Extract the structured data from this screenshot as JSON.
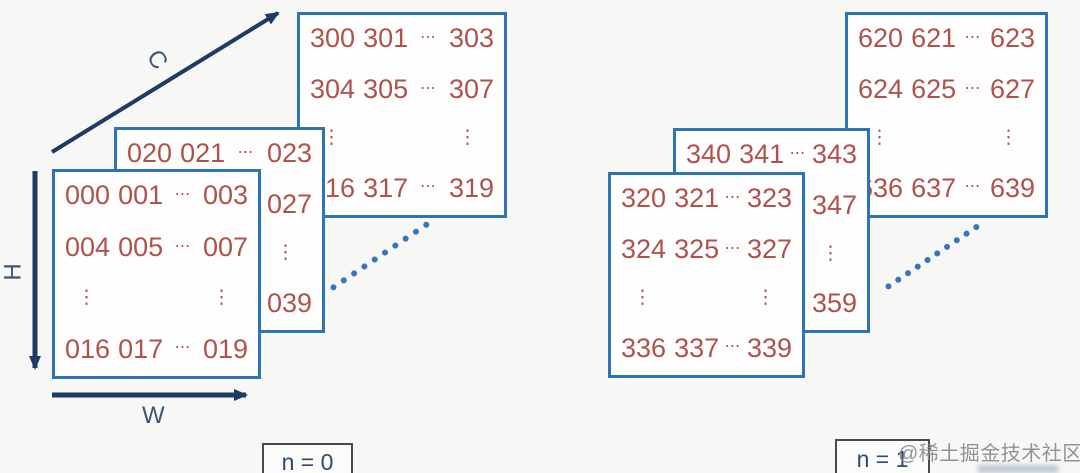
{
  "diagram": {
    "description": "NCHW tensor memory layout",
    "watermark": "@稀土掘金技术社区"
  },
  "colors": {
    "background": "#f7f7f5",
    "matrix_border": "#2e74b5",
    "matrix_fill": "#fefefe",
    "number_text": "#b0524c",
    "axis_arrow": "#1f3a64",
    "axis_label_text": "#3d5677",
    "dotted_line": "#3b74b8",
    "n_box_border": "#4a4a4a",
    "n_label_text": "#2e4b6f",
    "watermark_text": "#8a8a8a"
  },
  "axis_labels": {
    "c": "C",
    "h": "H",
    "w": "W"
  },
  "groups": [
    {
      "label": "n = 0",
      "matrices": {
        "back": {
          "rows": [
            [
              "300",
              "301",
              "⋯",
              "303"
            ],
            [
              "304",
              "305",
              "⋯",
              "307"
            ],
            [
              "⋮",
              "⋮"
            ],
            [
              "316",
              "317",
              "⋯",
              "319"
            ]
          ]
        },
        "middle": {
          "rows": [
            [
              "020",
              "021",
              "⋯",
              "023"
            ],
            [
              "024",
              "025",
              "⋯",
              "027"
            ],
            [
              "⋮",
              "⋮"
            ],
            [
              "036",
              "037",
              "⋯",
              "039"
            ]
          ]
        },
        "front": {
          "rows": [
            [
              "000",
              "001",
              "⋯",
              "003"
            ],
            [
              "004",
              "005",
              "⋯",
              "007"
            ],
            [
              "⋮",
              "⋮"
            ],
            [
              "016",
              "017",
              "⋯",
              "019"
            ]
          ]
        }
      }
    },
    {
      "label": "n = 1",
      "matrices": {
        "back": {
          "rows": [
            [
              "620",
              "621",
              "⋯",
              "623"
            ],
            [
              "624",
              "625",
              "⋯",
              "627"
            ],
            [
              "⋮",
              "⋮"
            ],
            [
              "636",
              "637",
              "⋯",
              "639"
            ]
          ]
        },
        "middle": {
          "rows": [
            [
              "340",
              "341",
              "⋯",
              "343"
            ],
            [
              "344",
              "345",
              "⋯",
              "347"
            ],
            [
              "⋮",
              "⋮"
            ],
            [
              "356",
              "357",
              "⋯",
              "359"
            ]
          ]
        },
        "front": {
          "rows": [
            [
              "320",
              "321",
              "⋯",
              "323"
            ],
            [
              "324",
              "325",
              "⋯",
              "327"
            ],
            [
              "⋮",
              "⋮"
            ],
            [
              "336",
              "337",
              "⋯",
              "339"
            ]
          ]
        }
      }
    }
  ]
}
